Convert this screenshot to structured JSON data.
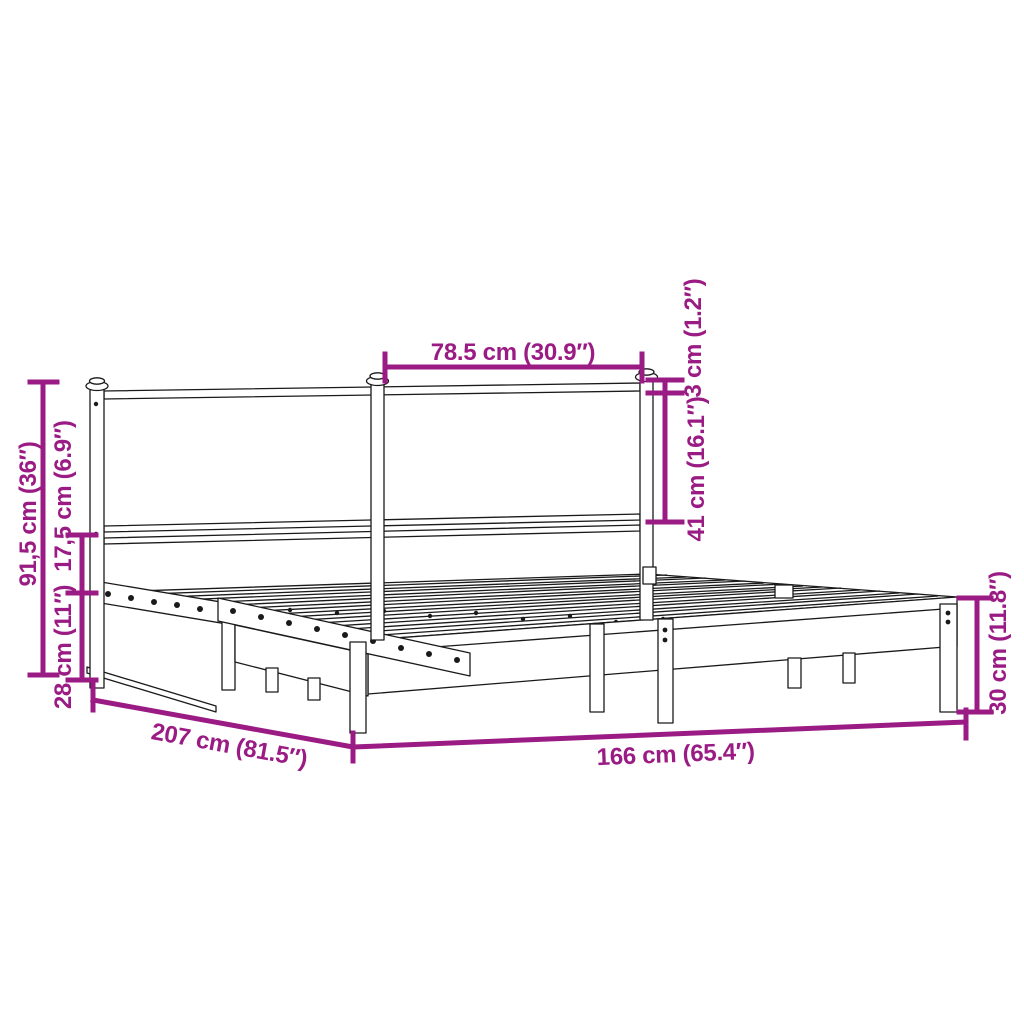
{
  "title": "Metal bed frame dimension diagram",
  "product": {
    "name": "metal bed frame with headboard"
  },
  "colors": {
    "dimension_accent": "#9B1B84",
    "line_art": "#1A1A1A",
    "background": "#FFFFFF"
  },
  "dimensions": {
    "headboard_section_width": "78.5 cm (30.9″)",
    "finial_height": "3 cm (1.2″)",
    "headboard_panel_height": "41 cm (16.1″)",
    "headboard_total_height": "91,5 cm (36″)",
    "rail_gap_height": "17,5 cm (6.9″)",
    "head_base_height": "28 cm (11″)",
    "frame_length": "207 cm (81.5″)",
    "frame_width": "166 cm (65.4″)",
    "foot_base_height": "30 cm (11.8″)"
  }
}
